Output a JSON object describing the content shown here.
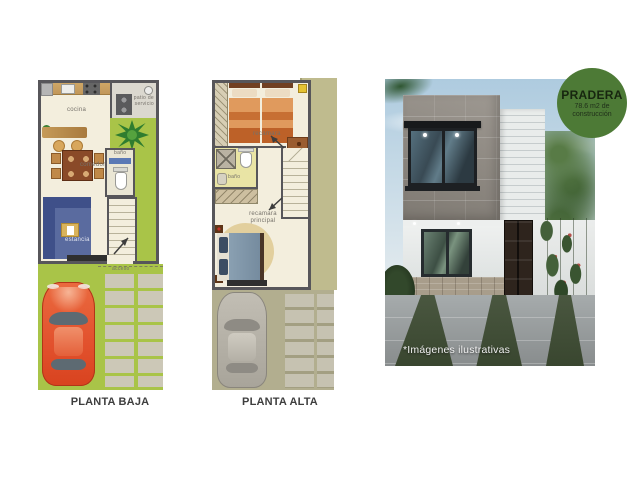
{
  "floor_plans": [
    {
      "id": "planta-baja",
      "title": "PLANTA BAJA",
      "labels": {
        "cocina": "cocina",
        "patio_servicio": "patio de servicio",
        "comedor": "comedor",
        "bano": "baño",
        "estancia": "estancia",
        "acceso": "acceso"
      }
    },
    {
      "id": "planta-alta",
      "title": "PLANTA ALTA",
      "labels": {
        "recamara": "recamara",
        "bano": "baño",
        "recamara_principal": "recamara principal"
      }
    }
  ],
  "render": {
    "badge": {
      "title": "PRADERA",
      "area_line1": "78.6 m2 de",
      "area_line2": "construcción",
      "background_color": "#4d7a36"
    },
    "disclaimer": "*Imágenes ilustrativas"
  },
  "colors": {
    "badge_green": "#4d7a36",
    "plan_wall": "#57565a",
    "plan_floor": "#f3eedd",
    "grass": "#a9c448",
    "car_red": "#e2512d",
    "roof_olive": "#bfbb8e"
  }
}
